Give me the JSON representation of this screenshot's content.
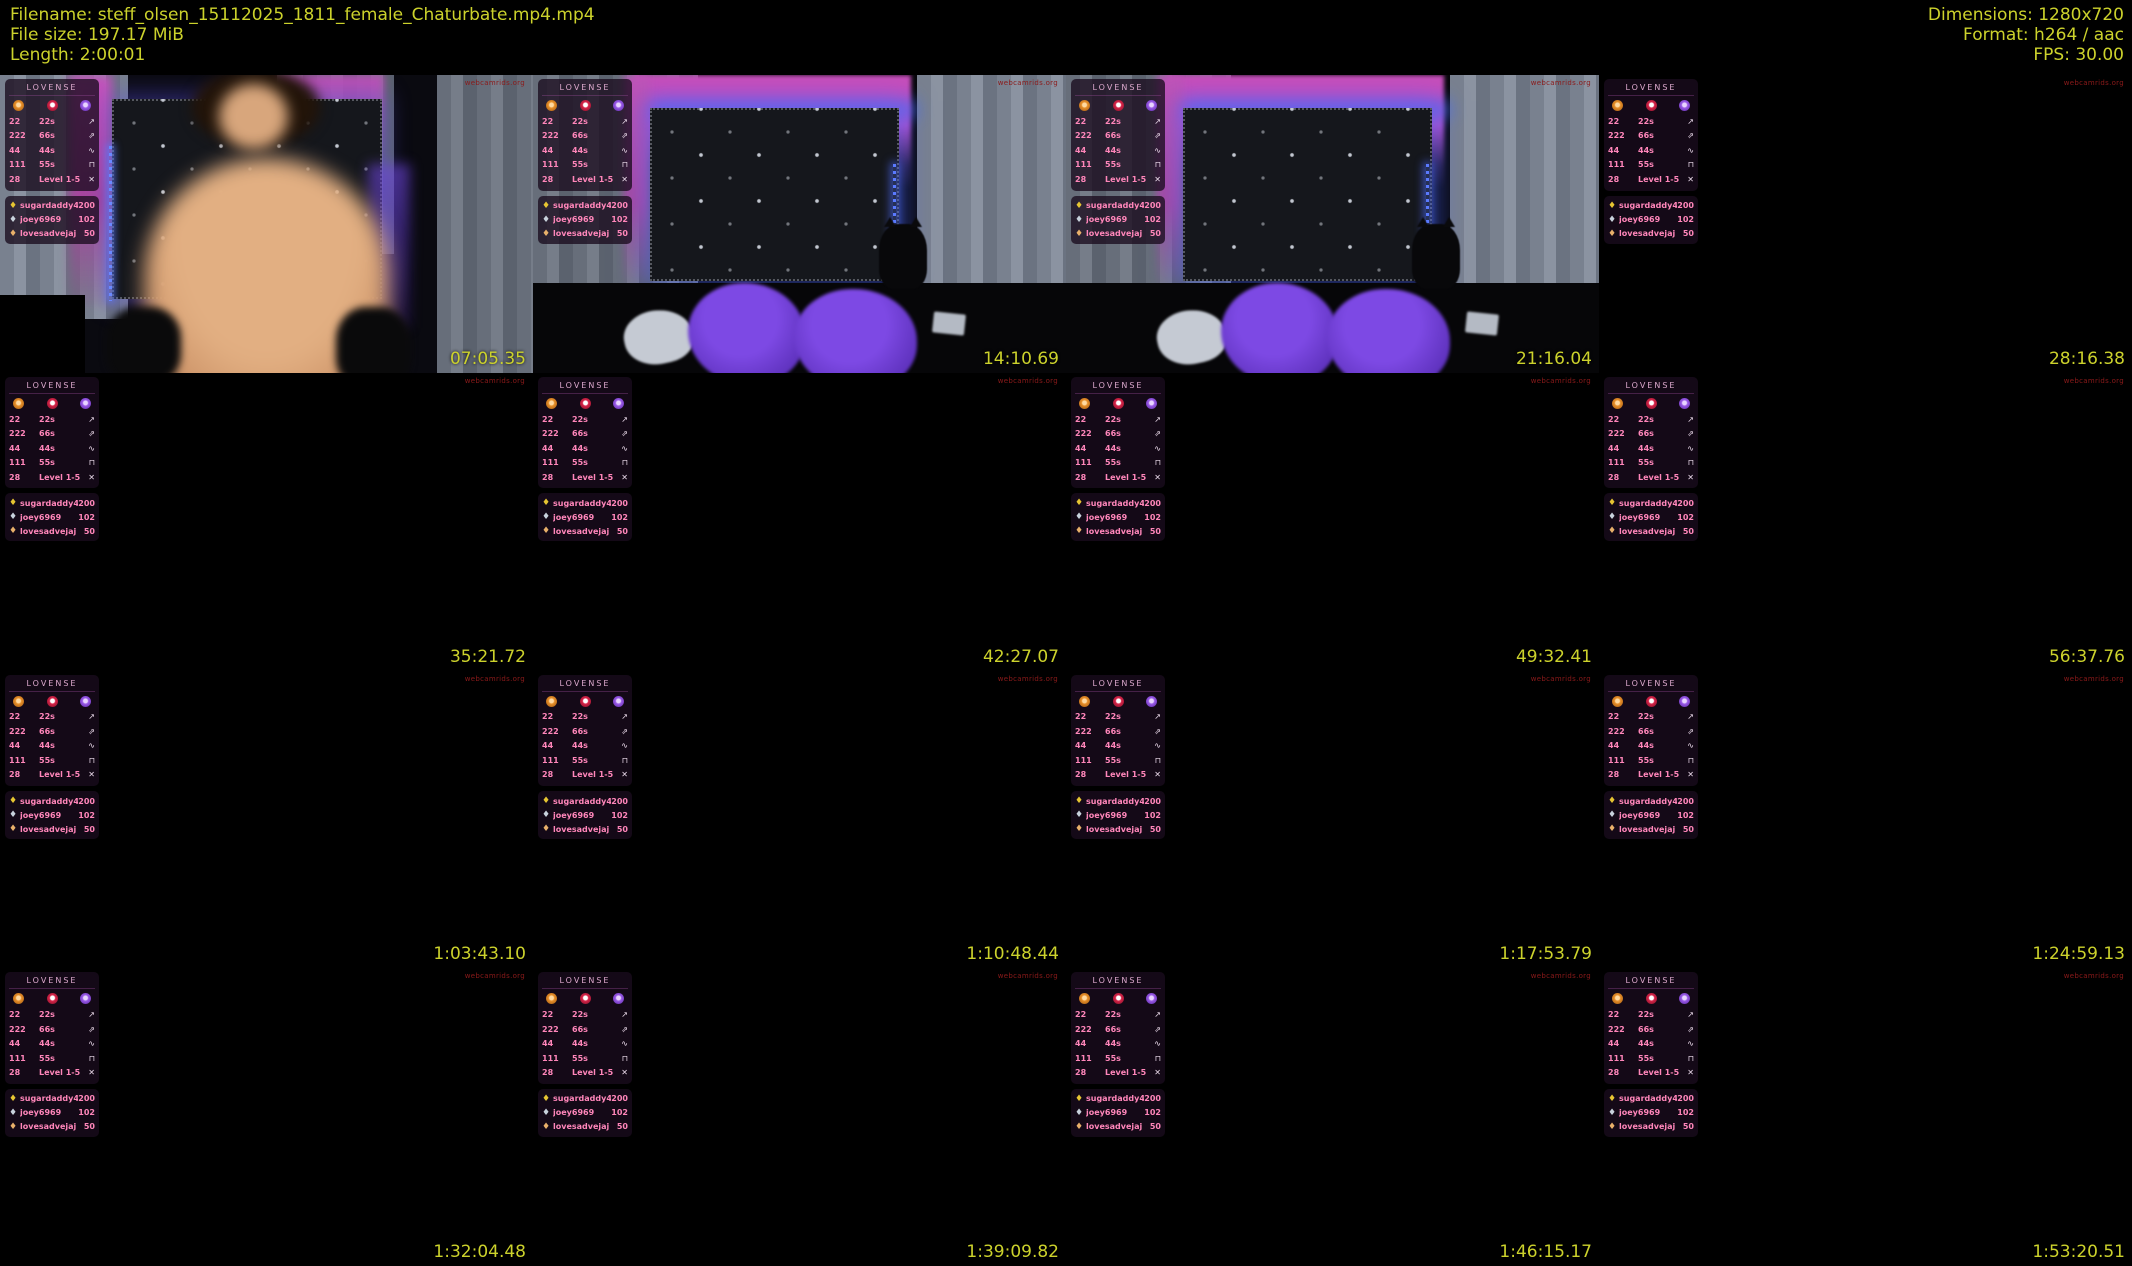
{
  "header": {
    "filename": "Filename: steff_olsen_15112025_1811_female_Chaturbate.mp4.mp4",
    "filesize": "File size: 197.17 MiB",
    "length": "Length: 2:00:01",
    "dimensions": "Dimensions: 1280x720",
    "format": "Format: h264 / aac",
    "fps": "FPS: 30.00"
  },
  "watermark": "webcamrids.org",
  "lovense": {
    "title": "LOVENSE",
    "menu_rows": [
      {
        "amount": "22",
        "duration": "22s",
        "icon": "↗"
      },
      {
        "amount": "222",
        "duration": "66s",
        "icon": "⇗"
      },
      {
        "amount": "44",
        "duration": "44s",
        "icon": "∿"
      },
      {
        "amount": "111",
        "duration": "55s",
        "icon": "⊓"
      },
      {
        "amount": "28",
        "duration": "Level 1-5",
        "icon": "✕"
      }
    ],
    "tippers": [
      {
        "icon": "♦",
        "name": "sugardaddy4me",
        "amount": "200"
      },
      {
        "icon": "♦",
        "name": "joey6969",
        "amount": "102"
      },
      {
        "icon": "♦",
        "name": "lovesadvejaj",
        "amount": "50"
      }
    ]
  },
  "grid": {
    "rows": 4,
    "cols": 4,
    "cells": [
      {
        "timestamp": "07:05.35",
        "scene": "cam"
      },
      {
        "timestamp": "14:10.69",
        "scene": "bedroom"
      },
      {
        "timestamp": "21:16.04",
        "scene": "bedroom"
      },
      {
        "timestamp": "28:16.38",
        "scene": "dark"
      },
      {
        "timestamp": "35:21.72",
        "scene": "dark"
      },
      {
        "timestamp": "42:27.07",
        "scene": "dark"
      },
      {
        "timestamp": "49:32.41",
        "scene": "dark"
      },
      {
        "timestamp": "56:37.76",
        "scene": "dark"
      },
      {
        "timestamp": "1:03:43.10",
        "scene": "dark"
      },
      {
        "timestamp": "1:10:48.44",
        "scene": "dark"
      },
      {
        "timestamp": "1:17:53.79",
        "scene": "dark"
      },
      {
        "timestamp": "1:24:59.13",
        "scene": "dark"
      },
      {
        "timestamp": "1:32:04.48",
        "scene": "dark"
      },
      {
        "timestamp": "1:39:09.82",
        "scene": "dark"
      },
      {
        "timestamp": "1:46:15.17",
        "scene": "dark"
      },
      {
        "timestamp": "1:53:20.51",
        "scene": "dark"
      }
    ]
  },
  "colors": {
    "header_text": "#ccd22c",
    "timestamp_text": "#ccd22c",
    "menu_pink": "#ff86ba",
    "watermark_red": "#8b1a1a",
    "background": "#000000"
  }
}
